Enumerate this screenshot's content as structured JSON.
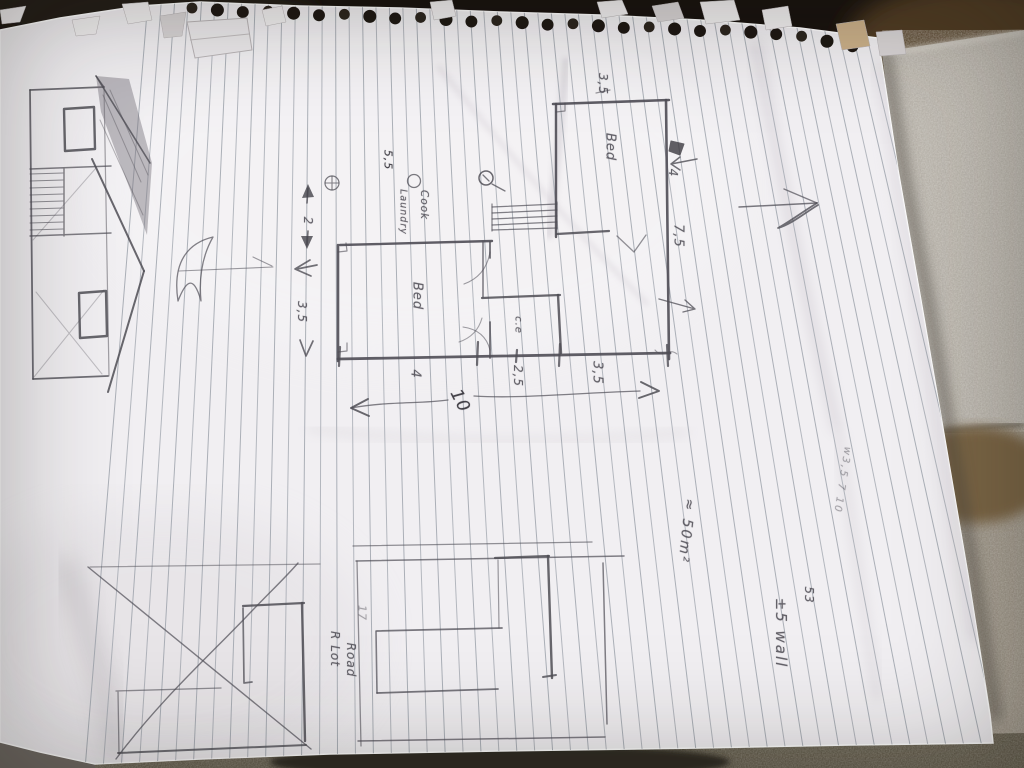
{
  "photo": {
    "subject": "hand-drawn floor plan sketch on spiral notebook page",
    "labels": {
      "top_dim": "3,5",
      "bed_right": "Bed",
      "note": "5,5",
      "cook": "Cook",
      "laundry": "Laundry",
      "bed_mid": "Bed",
      "ce": "c.e",
      "left_2": "2",
      "left_35": "3,5",
      "bottom_4": "4",
      "bottom_25": "2,5",
      "bottom_35": "3,5",
      "total_10": "10",
      "right_4": "4",
      "right_75": "7,5",
      "area": "≈ 50m²",
      "margin_note": "w3,5 7 10",
      "num_53": "53",
      "wall": "±5 wall",
      "lot_17": "17",
      "road": "Road",
      "r_lot": "R Lot"
    },
    "palette": {
      "paper": "#f1eff2",
      "pencil": "#4c4a52",
      "rule_line": "#9aa0a9",
      "concrete": "#b5b0a8",
      "ground_dark": "#2f2a22",
      "background_brown": "#503a22"
    }
  }
}
